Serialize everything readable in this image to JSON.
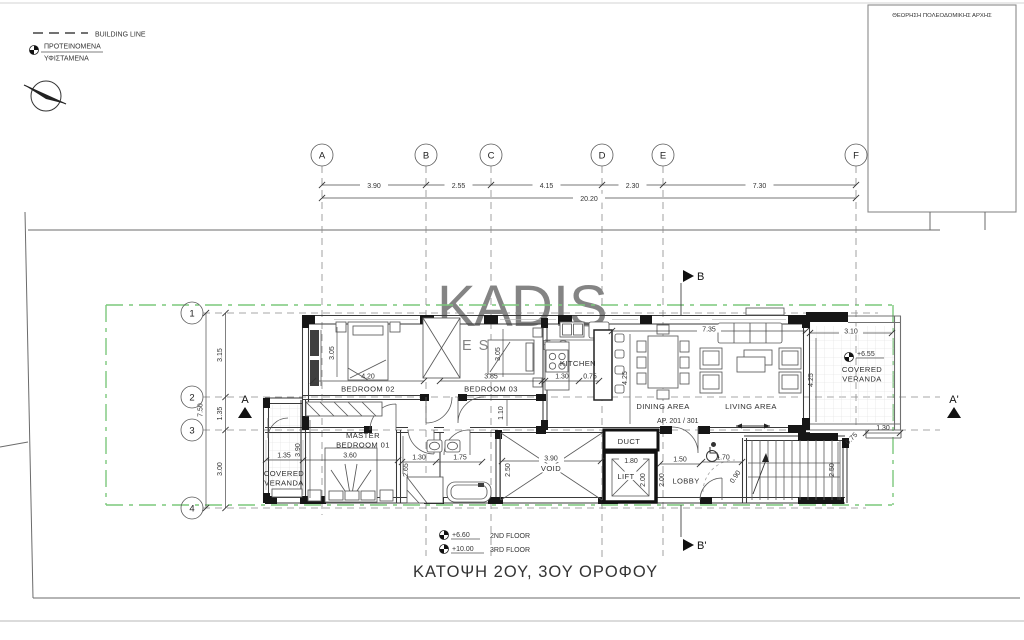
{
  "legend": {
    "building_line": "BUILDING LINE",
    "proposed": "ΠΡΟΤΕΙΝΟΜΕΝΑ",
    "existing": "ΥΦΙΣΤΑΜΕΝΑ"
  },
  "approval_box": {
    "title": "ΘΕΩΡΗΣΗ ΠΟΛΕΟΔΟΜΙΚΗΣ ΑΡΧΗΣ"
  },
  "watermark": {
    "part1": "K",
    "part2": "A",
    "part3": "DIS",
    "sub": "ESTATES"
  },
  "grid": {
    "cols": [
      {
        "label": "A"
      },
      {
        "label": "B"
      },
      {
        "label": "C"
      },
      {
        "label": "D"
      },
      {
        "label": "E"
      },
      {
        "label": "F"
      }
    ],
    "col_dims": [
      "3.90",
      "2.55",
      "4.15",
      "2.30",
      "7.30"
    ],
    "col_total": "20.20",
    "rows": [
      {
        "label": "1"
      },
      {
        "label": "2"
      },
      {
        "label": "3"
      },
      {
        "label": "4"
      }
    ],
    "row_dims": [
      "3.15",
      "1.35",
      "3.00"
    ],
    "row_total": "7.50"
  },
  "sections": {
    "a": "A",
    "a_prime": "A'",
    "b": "B",
    "b_prime": "B'"
  },
  "rooms": {
    "bedroom02": "BEDROOM 02",
    "bedroom03": "BEDROOM 03",
    "kitchen": "KITCHEN",
    "dining": "DINING AREA",
    "living": "LIVING AREA",
    "master1": "MASTER",
    "master2": "BEDROOM 01",
    "void": "VOID",
    "duct": "DUCT",
    "lift": "LIFT",
    "lobby": "LOBBY",
    "veranda1": "COVERED",
    "veranda2": "VERANDA"
  },
  "dims": {
    "bed02_w": "4.20",
    "bed02_h": "3.05",
    "bed03_w": "3.85",
    "bed03_h": "3.05",
    "kitchen_w": "1.30",
    "island_gap": "0.75",
    "dining_h": "4.25",
    "living_w": "7.35",
    "ver_r_w": "3.10",
    "ver_r_h": "4.25",
    "ver_r_step": "1.30",
    "ver_r_step2": "0.75",
    "master_w": "3.60",
    "master_h": "3.90",
    "ver_l_w": "1.35",
    "bath1_w": "1.30",
    "bath2_w": "1.75",
    "bath_h": "2.65",
    "void_w": "3.90",
    "void_h": "2.50",
    "lift_w": "1.80",
    "lift_h": "2.00",
    "lobby_w": "1.50",
    "lobby_h": "2.00",
    "stair_w": "1.70",
    "stair_arc": "0.90",
    "stair_h": "2.50",
    "hall_w": "1.10"
  },
  "levels": {
    "veranda": "+6.55",
    "second_value": "+6.60",
    "second_label": "2ND FLOOR",
    "third_value": "+10.00",
    "third_label": "3RD FLOOR"
  },
  "apartment": "AP. 201 / 301",
  "title": "ΚΑΤΟΨΗ 2ΟΥ, 3ΟΥ ΟΡΟΦΟΥ",
  "colors": {
    "building_line_green": "#7cc87c",
    "wall": "#3a3a3a",
    "watermark_gold": "#c09a5e"
  }
}
